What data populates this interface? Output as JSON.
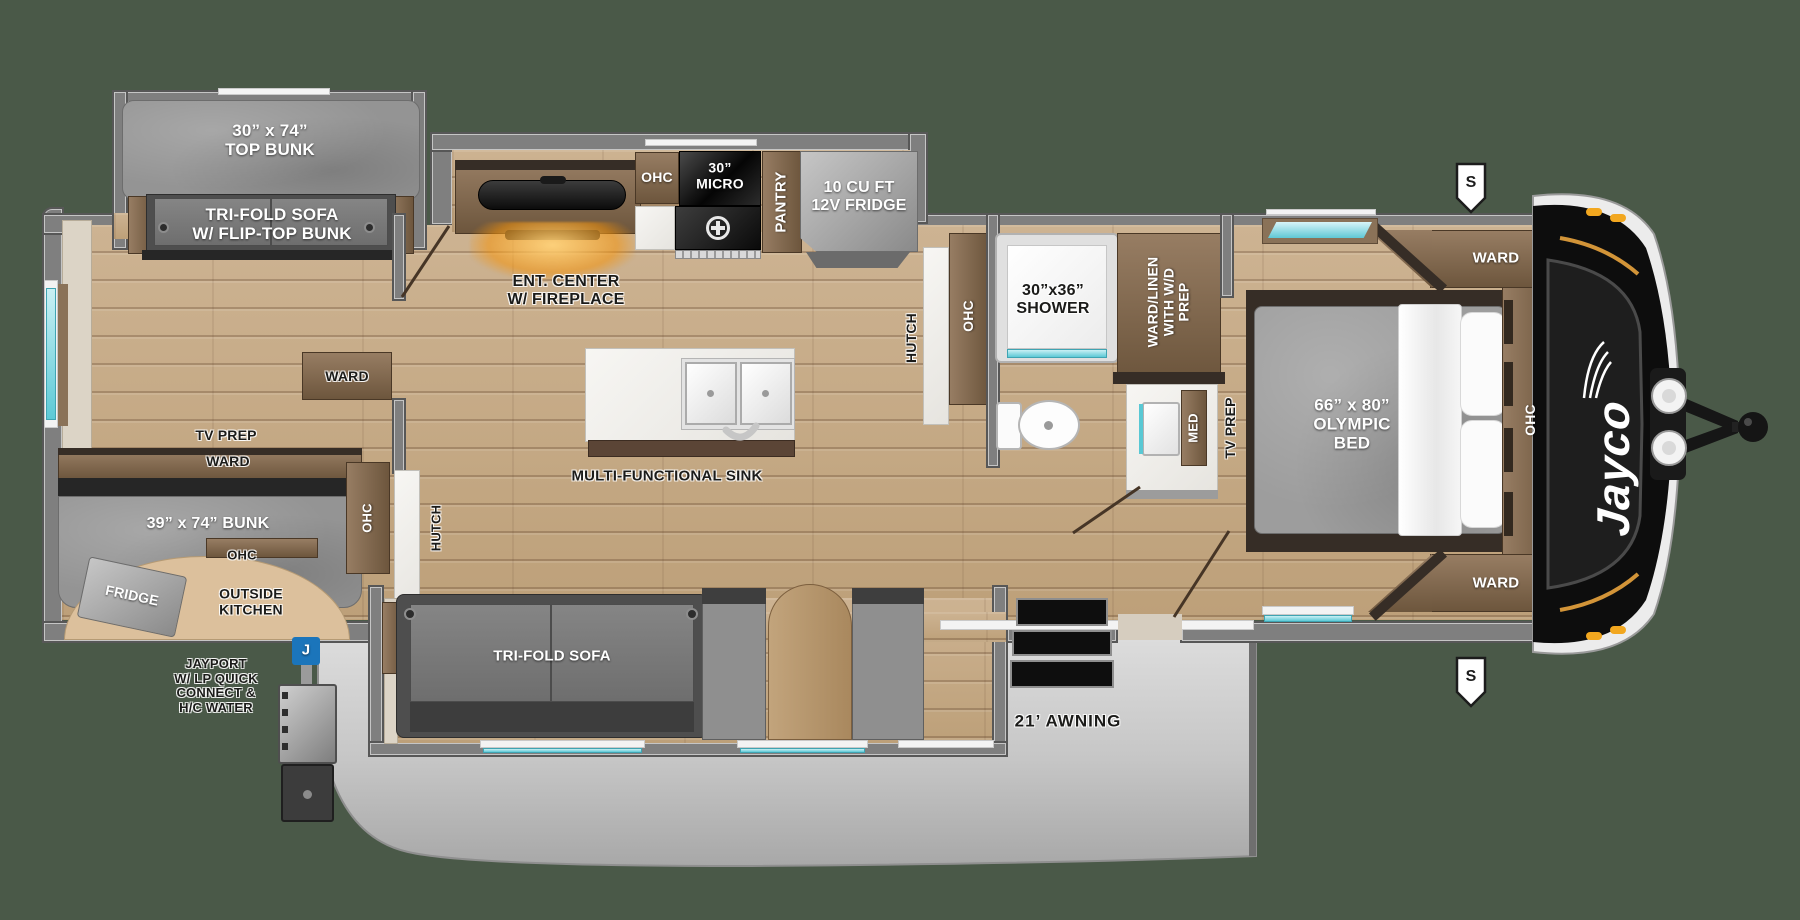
{
  "canvas": {
    "background_color": "#4a5948"
  },
  "floorplan": {
    "brand_logo": "Jayco",
    "markers": {
      "street_side_top": "S",
      "street_side_bottom": "S",
      "jayport_badge": "J"
    },
    "colors": {
      "accent_blue": "#1b75bb",
      "window_teal": "#5cc9d6",
      "fireplace_glow": "#f5930a"
    },
    "labels": {
      "top_bunk": "30” x 74”\nTOP BUNK",
      "trifold_sofa_bunk": "TRI-FOLD SOFA\nW/ FLIP-TOP BUNK",
      "ent_center": "ENT. CENTER\nW/ FIREPLACE",
      "ohc_galley": "OHC",
      "micro": "30”\nMICRO",
      "pantry": "PANTRY",
      "fridge": "10 CU FT\n12V FRIDGE",
      "hutch_bath": "HUTCH",
      "ohc_bath": "OHC",
      "shower": "30”x36”\nSHOWER",
      "ward_linen": "WARD/LINEN\nWITH W/D\nPREP",
      "med": "MED",
      "tv_prep_bedroom": "TV PREP",
      "ward_front_top": "WARD",
      "ward_front_bottom": "WARD",
      "ohc_bedroom": "OHC",
      "olympic_bed": "66” x 80”\nOLYMPIC\nBED",
      "tv_prep_rear": "TV PREP",
      "ward_rear": "WARD",
      "rear_bunk": "39” x 74” BUNK",
      "outside_fridge": "FRIDGE",
      "ohc_outside": "OHC",
      "outside_kitchen": "OUTSIDE\nKITCHEN",
      "jayport": "JAYPORT\nW/ LP QUICK\nCONNECT &\nH/C WATER",
      "multi_sink": "MULTI-FUNCTIONAL SINK",
      "ward_mid": "WARD",
      "ohc_mid": "OHC",
      "hutch_mid": "HUTCH",
      "trifold_sofa": "TRI-FOLD SOFA",
      "awning": "21’ AWNING"
    }
  }
}
